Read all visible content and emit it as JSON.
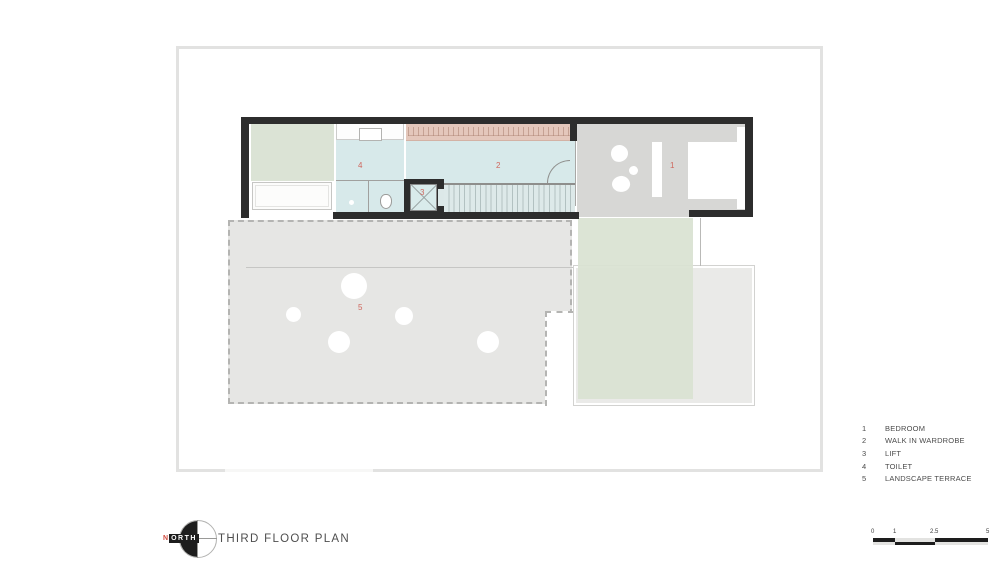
{
  "colors": {
    "wall": "#2d2d2d",
    "room_blue": "#d7e9ea",
    "room_green": "#dbe3d5",
    "bedroom_gray": "#d7d7d5",
    "terrace_gray": "#e6e6e4",
    "wardrobe_tan": "#e4c7bb",
    "accent_red": "#cf675e",
    "frame_gray": "#e2e2e1"
  },
  "rooms": {
    "bedroom": {
      "num": "1"
    },
    "wardrobe": {
      "num": "2"
    },
    "lift": {
      "num": "3"
    },
    "toilet": {
      "num": "4"
    },
    "terrace": {
      "num": "5"
    }
  },
  "legend": {
    "items": [
      {
        "num": "1",
        "label": "BEDROOM"
      },
      {
        "num": "2",
        "label": "WALK IN WARDROBE"
      },
      {
        "num": "3",
        "label": "LIFT"
      },
      {
        "num": "4",
        "label": "TOILET"
      },
      {
        "num": "5",
        "label": "LANDSCAPE TERRACE"
      }
    ]
  },
  "title_block": {
    "north_label_first": "N",
    "north_label_rest": "ORTH",
    "title": "THIRD FLOOR PLAN"
  },
  "scale_bar": {
    "ticks": [
      "0",
      "1",
      "2.5",
      "5"
    ]
  }
}
